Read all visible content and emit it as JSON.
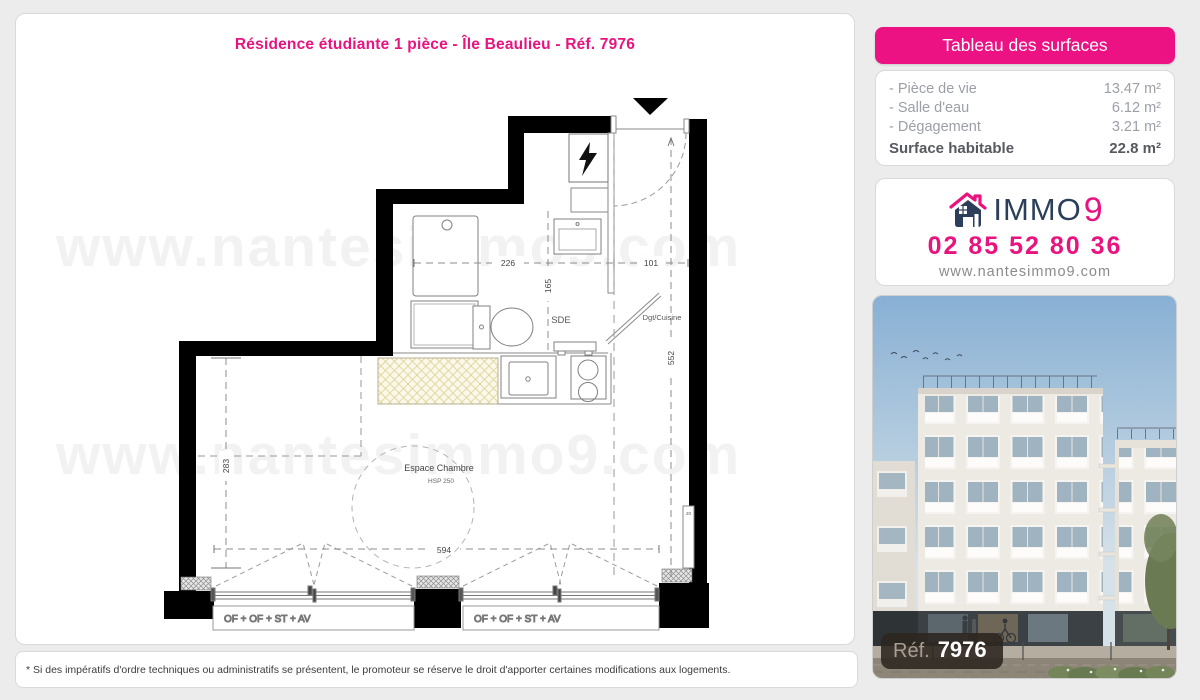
{
  "page": {
    "title": "Résidence étudiante 1 pièce - Île Beaulieu - Réf. 7976",
    "watermark": "www.nantesimmo9.com",
    "disclaimer": "* Si des impératifs d'ordre techniques ou administratifs se présentent, le promoteur se réserve le droit d'apporter certaines modifications aux logements."
  },
  "surfaces": {
    "header": "Tableau des surfaces",
    "rows": [
      {
        "label": "- Pièce de vie",
        "value": "13.47 m²"
      },
      {
        "label": "- Salle d'eau",
        "value": "6.12 m²"
      },
      {
        "label": "- Dégagement",
        "value": "3.21 m²"
      }
    ],
    "total_label": "Surface habitable",
    "total_value": "22.8 m²"
  },
  "agency": {
    "brand_immo": "IMMO",
    "brand_9": "9",
    "phone": "02 85 52 80 36",
    "website": "www.nantesimmo9.com"
  },
  "photo": {
    "ref_label": "Réf.",
    "ref_number": "7976"
  },
  "plan": {
    "room_labels": {
      "sde": "SDE",
      "dgt_cuisine": "Dgt/Cuisine",
      "espace_chambre": "Espace Chambre",
      "hsp": "HSP 250"
    },
    "dimensions": {
      "d226": "226",
      "d165": "165",
      "d101": "101",
      "d552": "552",
      "d283": "283",
      "d594": "594"
    },
    "windows": [
      "OF + OF + ST + AV",
      "OF + OF + ST + AV"
    ],
    "radiator_label": "20"
  },
  "colors": {
    "accent": "#e8137f",
    "navy": "#2c3e5a"
  }
}
